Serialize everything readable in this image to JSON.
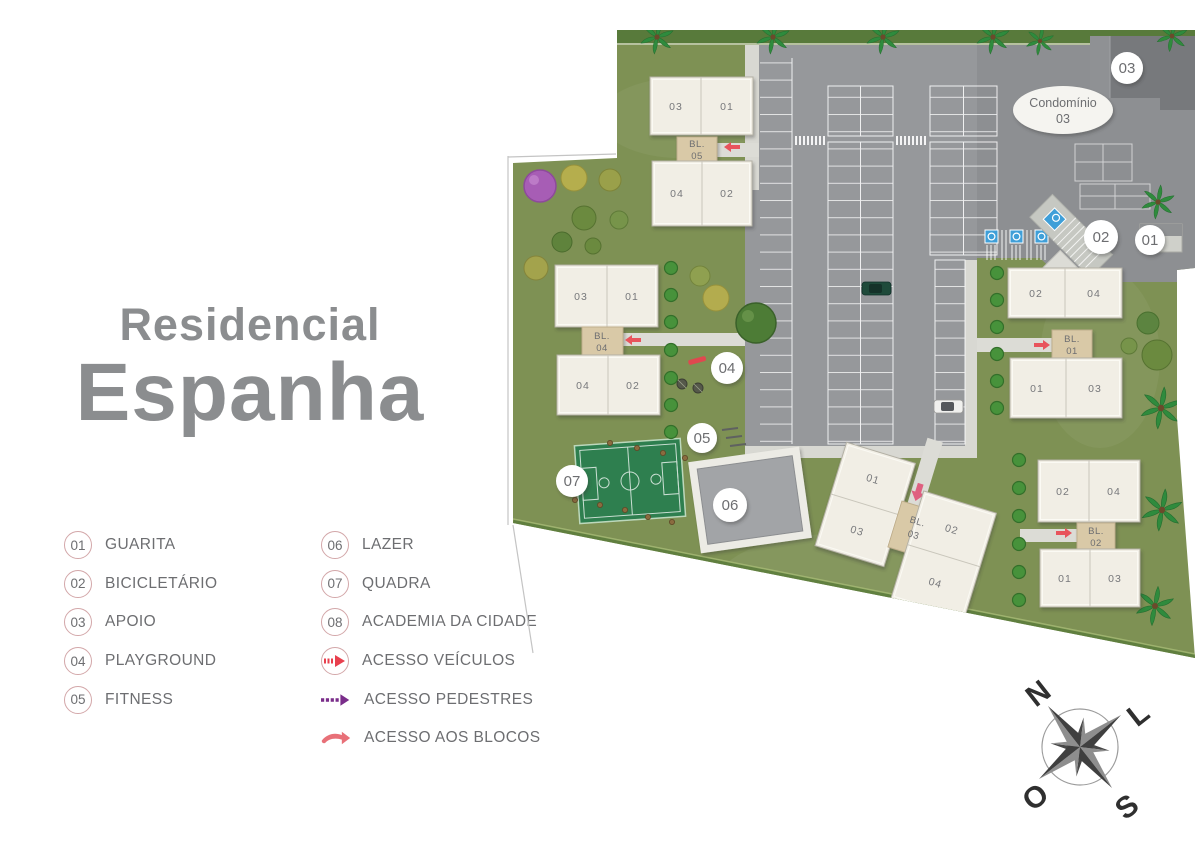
{
  "title": {
    "line1": "Residencial",
    "line2": "Espanha"
  },
  "legend": {
    "items": [
      {
        "num": "01",
        "label": "GUARITA"
      },
      {
        "num": "02",
        "label": "BICICLETÁRIO"
      },
      {
        "num": "03",
        "label": "APOIO"
      },
      {
        "num": "04",
        "label": "PLAYGROUND"
      },
      {
        "num": "05",
        "label": "FITNESS"
      },
      {
        "num": "06",
        "label": "LAZER"
      },
      {
        "num": "07",
        "label": "QUADRA"
      },
      {
        "num": "08",
        "label": "ACADEMIA DA CIDADE"
      }
    ],
    "access": [
      {
        "id": "vehicles",
        "label": "ACESSO VEÍCULOS"
      },
      {
        "id": "pedestrians",
        "label": "ACESSO PEDESTRES"
      },
      {
        "id": "blocks",
        "label": "ACESSO AOS BLOCOS"
      }
    ]
  },
  "plan": {
    "condo": {
      "line1": "Condomínio",
      "line2": "03"
    },
    "markers": {
      "m01": "01",
      "m02": "02",
      "m03": "03",
      "m04": "04",
      "m05": "05",
      "m06": "06",
      "m07": "07"
    },
    "blocks": [
      {
        "id": "bl05",
        "l1": "BL.",
        "l2": "05",
        "units": {
          "tl": "03",
          "tr": "01",
          "bl": "04",
          "br": "02"
        }
      },
      {
        "id": "bl04",
        "l1": "BL.",
        "l2": "04",
        "units": {
          "tl": "03",
          "tr": "01",
          "bl": "04",
          "br": "02"
        }
      },
      {
        "id": "bl01",
        "l1": "BL.",
        "l2": "01",
        "units": {
          "tl": "02",
          "tr": "04",
          "bl": "01",
          "br": "03"
        }
      },
      {
        "id": "bl02",
        "l1": "BL.",
        "l2": "02",
        "units": {
          "tl": "02",
          "tr": "04",
          "bl": "01",
          "br": "03"
        }
      },
      {
        "id": "bl03",
        "l1": "BL.",
        "l2": "03",
        "units": {
          "tl": "01",
          "tr": "02",
          "bl": "03",
          "br": "04"
        }
      }
    ],
    "compass": {
      "n": "N",
      "e": "L",
      "s": "S",
      "w": "O"
    }
  },
  "colors": {
    "accent_red": "#e8505a",
    "accent_purple": "#7b2e8c",
    "grass": "#7e9154",
    "parking": "#96989b",
    "building": "#f1eee5",
    "connector_tan": "#d9c9a7",
    "court_green": "#2e7f4f",
    "text_gray": "#6d6e71"
  }
}
